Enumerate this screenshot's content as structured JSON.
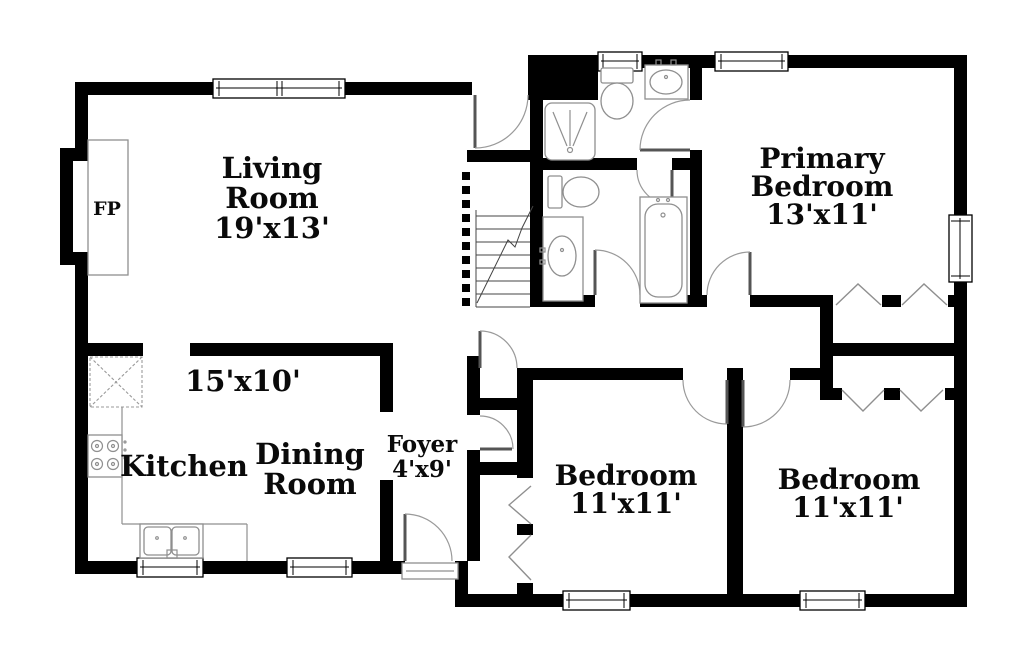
{
  "rooms": {
    "living": {
      "line1": "Living",
      "line2": "Room",
      "dims": "19'x13'"
    },
    "kitchen": {
      "label": "Kitchen"
    },
    "dining": {
      "line1": "Dining",
      "line2": "Room",
      "dims": "15'x10'"
    },
    "foyer": {
      "label": "Foyer",
      "dims": "4'x9'"
    },
    "primary": {
      "line1": "Primary",
      "line2": "Bedroom",
      "dims": "13'x11'"
    },
    "bedroom1": {
      "label": "Bedroom",
      "dims": "11'x11'"
    },
    "bedroom2": {
      "label": "Bedroom",
      "dims": "11'x11'"
    },
    "fireplace": {
      "label": "FP"
    }
  },
  "colors": {
    "wall": "#000000",
    "background": "#ffffff",
    "fixture_stroke": "#8f8f8f",
    "text": "#0a0a0a"
  },
  "fixture_icons": [
    "fireplace-icon",
    "refrigerator-icon",
    "range-icon",
    "kitchen-sink-icon",
    "shower-icon",
    "toilet-icon",
    "vanity-sink-icon",
    "bathtub-icon",
    "stairs-icon",
    "bifold-closet-door-icon",
    "window-icon",
    "door-swing-icon"
  ]
}
